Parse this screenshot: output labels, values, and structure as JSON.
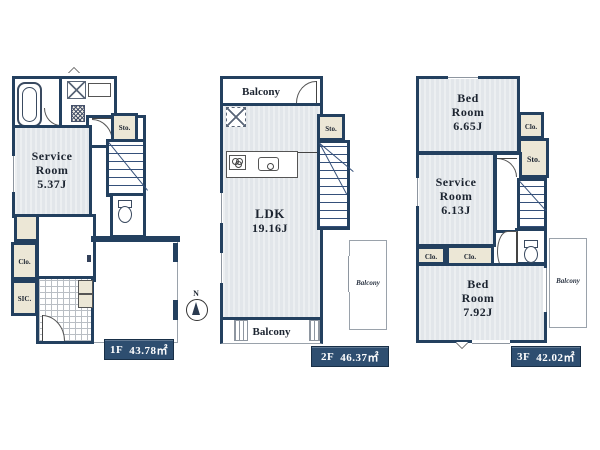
{
  "plan": {
    "compass": {
      "north_label": "N"
    },
    "colors": {
      "wall": "#23405f",
      "room_fill": "#e2e6ea",
      "closet_fill": "#ece7d6",
      "area_box": "#2e4e70",
      "area_text": "#ffffff"
    },
    "floors": [
      {
        "name": "1F",
        "area": "43.78㎡",
        "labels": {
          "service_room": "Service Room",
          "service_room_area": "5.37J",
          "clo_main": "Clo.",
          "clo_left": "Clo.",
          "sic": "SIC.",
          "sto": "Sto."
        }
      },
      {
        "name": "2F",
        "area": "46.37㎡",
        "labels": {
          "ldk": "LDK",
          "ldk_area": "19.16J",
          "balcony_top": "Balcony",
          "balcony_bottom": "Balcony",
          "balcony_right": "Balcony",
          "sto": "Sto."
        }
      },
      {
        "name": "3F",
        "area": "42.02㎡",
        "labels": {
          "bed_room_1": "Bed Room",
          "bed_room_1_area": "6.65J",
          "service_room": "Service Room",
          "service_room_area": "6.13J",
          "bed_room_2": "Bed Room",
          "bed_room_2_area": "7.92J",
          "clo_top": "Clo.",
          "sto": "Sto.",
          "clo_a": "Clo.",
          "clo_b": "Clo.",
          "balcony_right": "Balcony"
        }
      }
    ]
  }
}
